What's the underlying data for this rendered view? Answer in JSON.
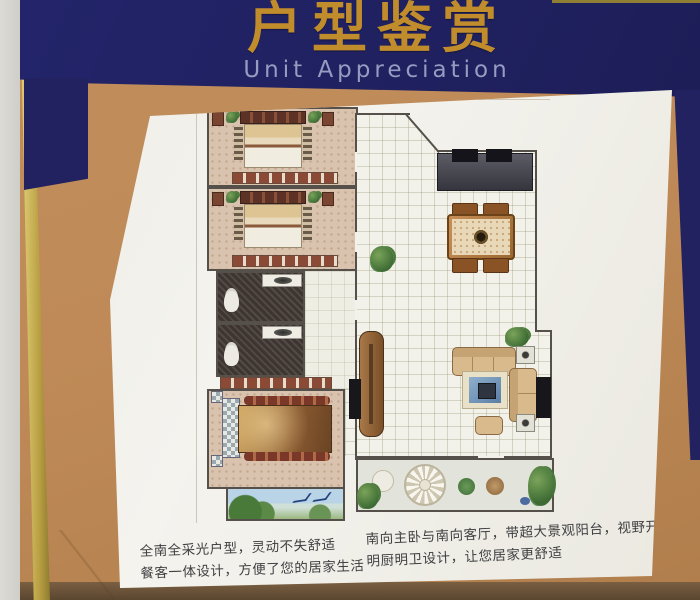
{
  "header": {
    "title": "户型鉴赏",
    "subtitle": "Unit Appreciation"
  },
  "captions": {
    "left": [
      "全南全采光户型，灵动不失舒适",
      "餐客一体设计，方便了您的居家生活"
    ],
    "right": [
      "南向主卧与南向客厅，带超大景观阳台，视野开阔",
      "明厨明卫设计，让您居家更舒适"
    ]
  },
  "floorplan": {
    "type": "residential-unit-floor-plan",
    "rooms": [
      "bedroom",
      "bedroom",
      "bathroom",
      "bathroom",
      "master-bedroom",
      "kitchen",
      "dining-area",
      "living-room",
      "hallway",
      "master-balcony",
      "landscape-balcony"
    ],
    "furniture_icons": [
      "bed-icon",
      "wardrobe-icon",
      "toilet-icon",
      "sink-icon",
      "kitchen-counter-icon",
      "stove-icon",
      "dining-table-icon",
      "chair-icon",
      "sofa-icon",
      "armchair-icon",
      "rug-icon",
      "coffee-table-icon",
      "tv-icon",
      "tv-cabinet-icon",
      "side-table-icon",
      "plant-icon",
      "floor-medallion-icon",
      "bird-icon"
    ]
  },
  "colors": {
    "header_navy": "#20215e",
    "title_gold": "#c08c2c",
    "subtitle_gray_blue": "#949cc0",
    "frame_gold": "#d6c153",
    "wall_tan": "#bf8a57",
    "panel_white": "#f1f0ea"
  }
}
